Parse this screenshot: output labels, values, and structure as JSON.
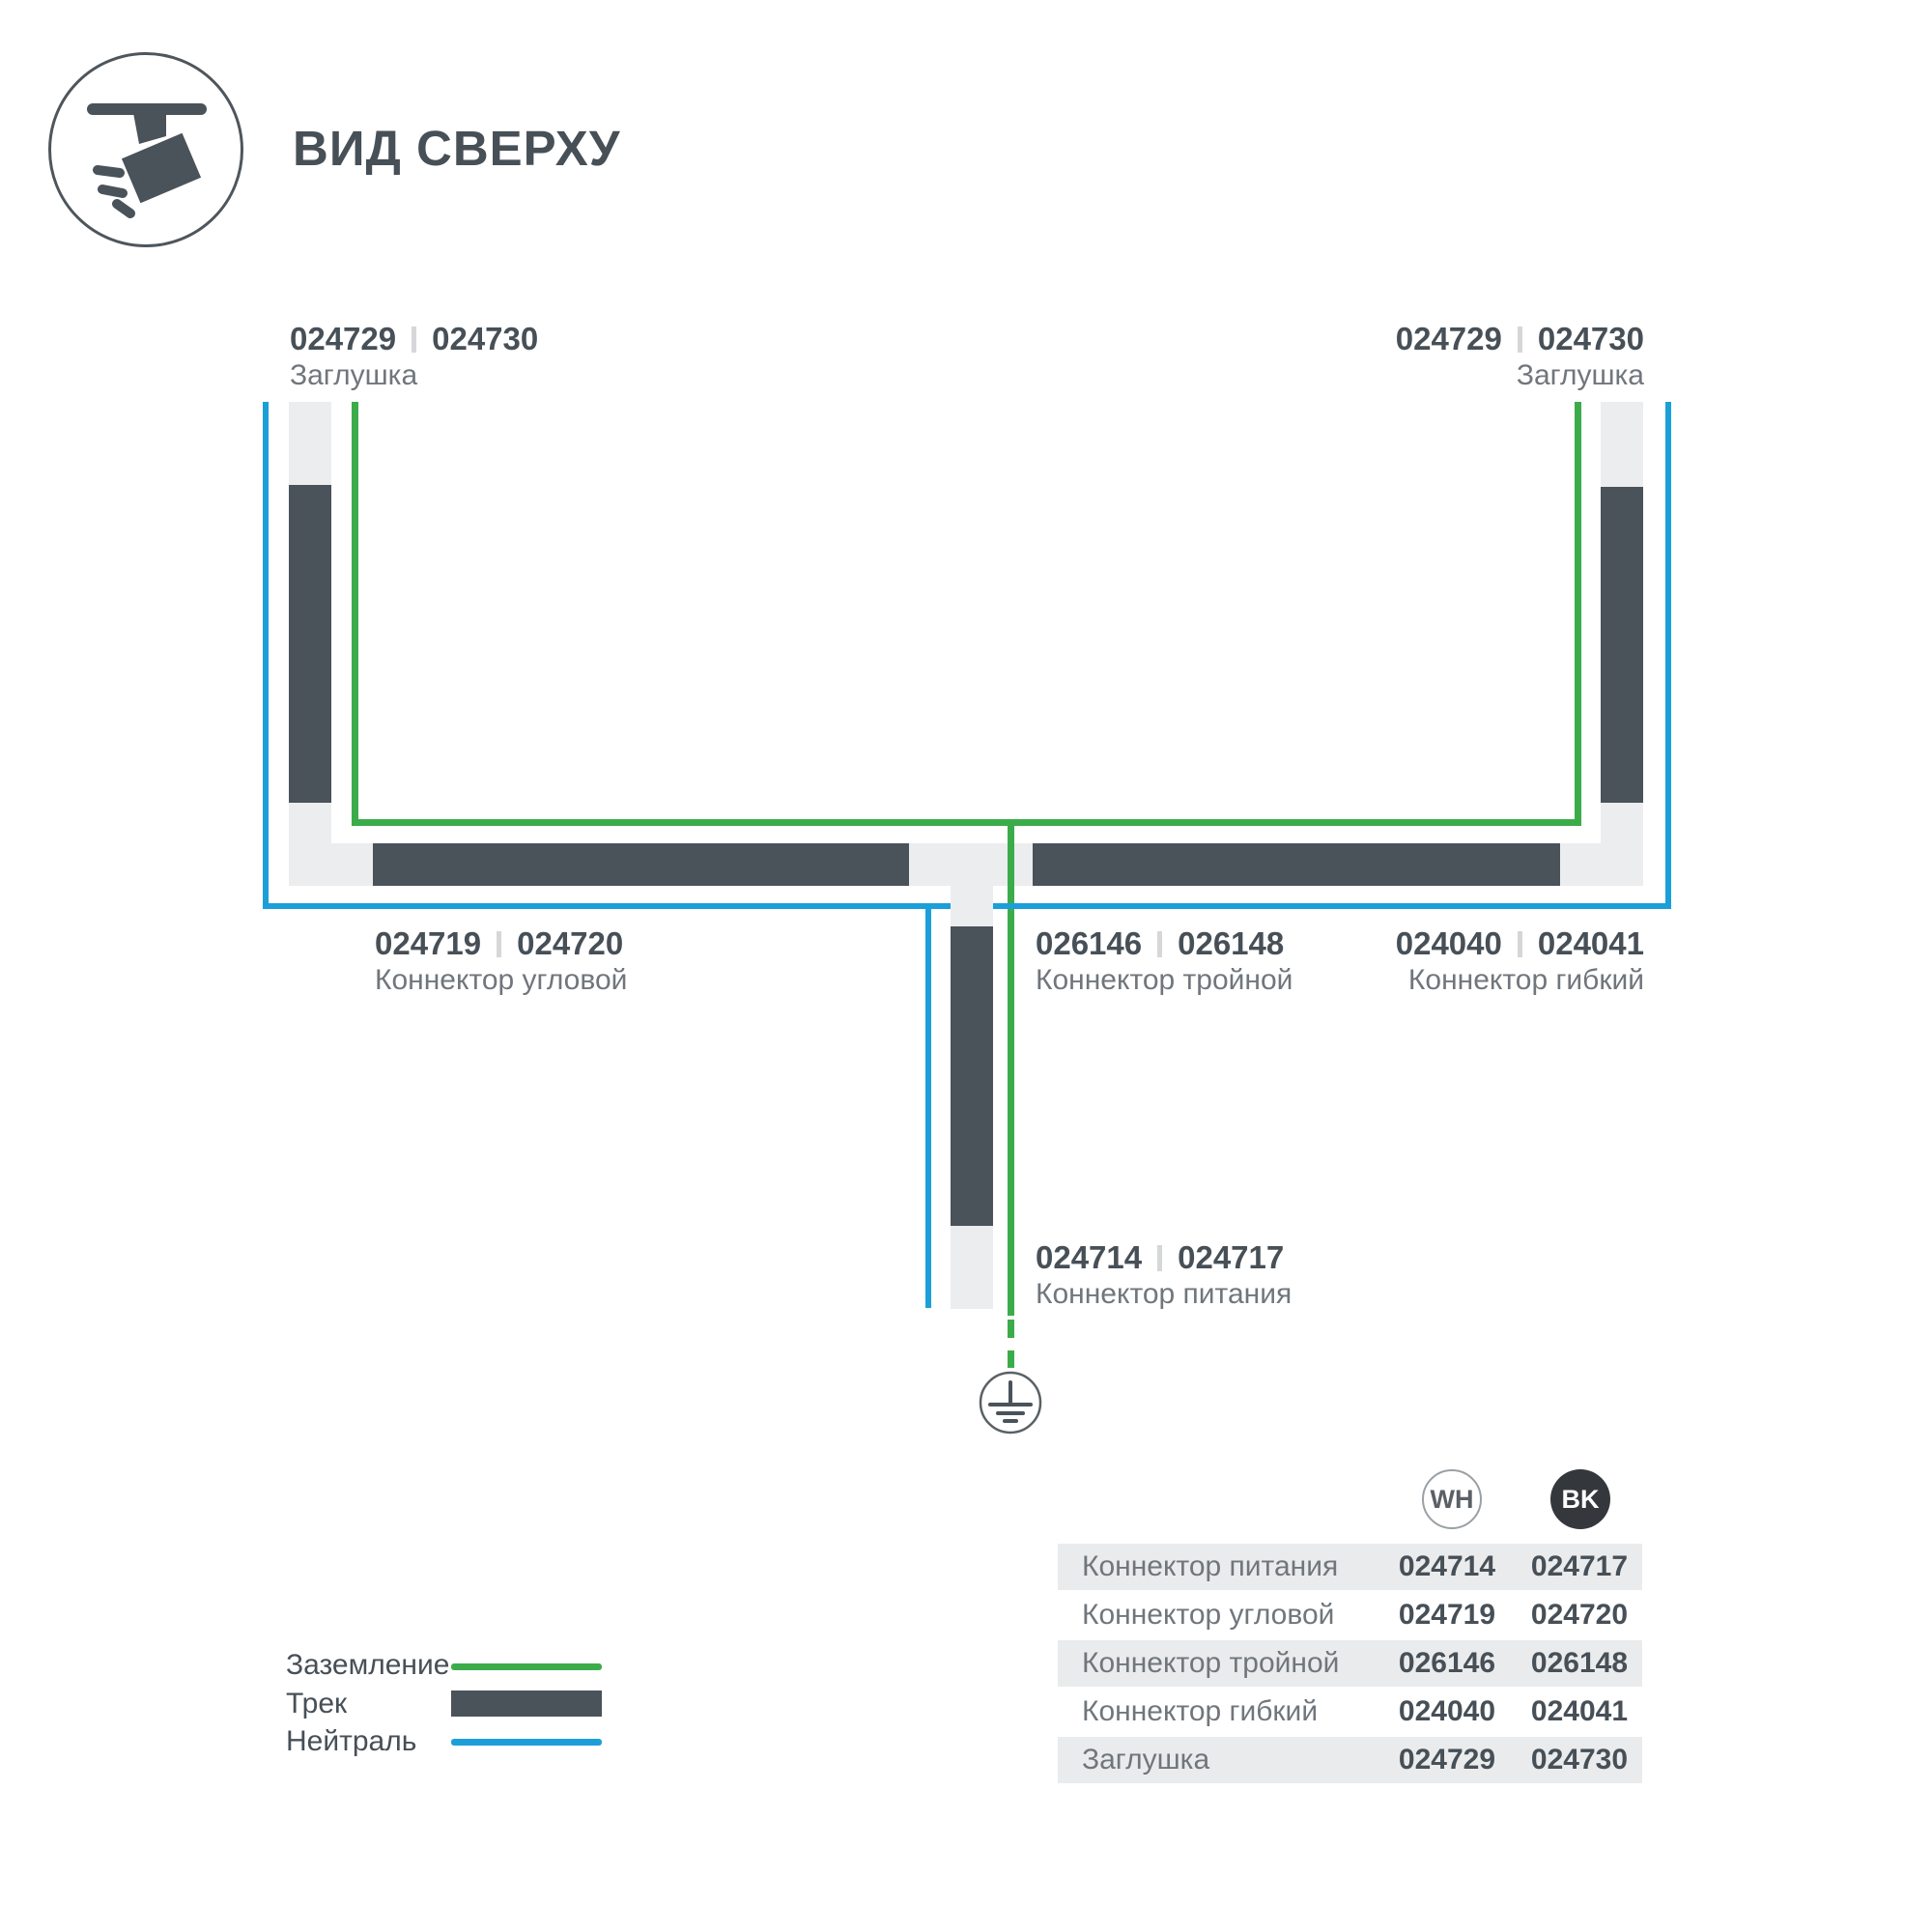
{
  "header": {
    "title": "ВИД СВЕРХУ"
  },
  "diagram": {
    "endcap_top_left": {
      "code_wh": "024729",
      "code_bk": "024730",
      "name": "Заглушка"
    },
    "endcap_top_right": {
      "code_wh": "024729",
      "code_bk": "024730",
      "name": "Заглушка"
    },
    "corner_connector": {
      "code_wh": "024719",
      "code_bk": "024720",
      "name": "Коннектор угловой"
    },
    "triple_connector": {
      "code_wh": "026146",
      "code_bk": "026148",
      "name": "Коннектор тройной"
    },
    "flex_connector": {
      "code_wh": "024040",
      "code_bk": "024041",
      "name": "Коннектор гибкий"
    },
    "power_connector": {
      "code_wh": "024714",
      "code_bk": "024717",
      "name": "Коннектор питания"
    }
  },
  "legend": {
    "items": [
      {
        "label": "Заземление",
        "swatch": "green-line"
      },
      {
        "label": "Трек",
        "swatch": "track-bar"
      },
      {
        "label": "Нейтраль",
        "swatch": "blue-line"
      }
    ]
  },
  "table": {
    "columns": [
      {
        "label": "WH"
      },
      {
        "label": "BK"
      }
    ],
    "rows": [
      {
        "name": "Коннектор питания",
        "wh": "024714",
        "bk": "024717"
      },
      {
        "name": "Коннектор угловой",
        "wh": "024719",
        "bk": "024720"
      },
      {
        "name": "Коннектор тройной",
        "wh": "026146",
        "bk": "026148"
      },
      {
        "name": "Коннектор гибкий",
        "wh": "024040",
        "bk": "024041"
      },
      {
        "name": "Заглушка",
        "wh": "024729",
        "bk": "024730"
      }
    ]
  },
  "colors": {
    "track": "#4A525A",
    "ground_wire_green": "#3CAC4B",
    "neutral_wire_blue": "#1C9FD9",
    "connector_light": "#ECEDEE",
    "text_dark": "#474F57",
    "text_gray": "#70767C",
    "table_row_bg": "#EAEBEC",
    "bk_badge": "#34383C"
  },
  "icons": {
    "header": "track-spotlight-icon",
    "ground": "ground-symbol-icon"
  }
}
